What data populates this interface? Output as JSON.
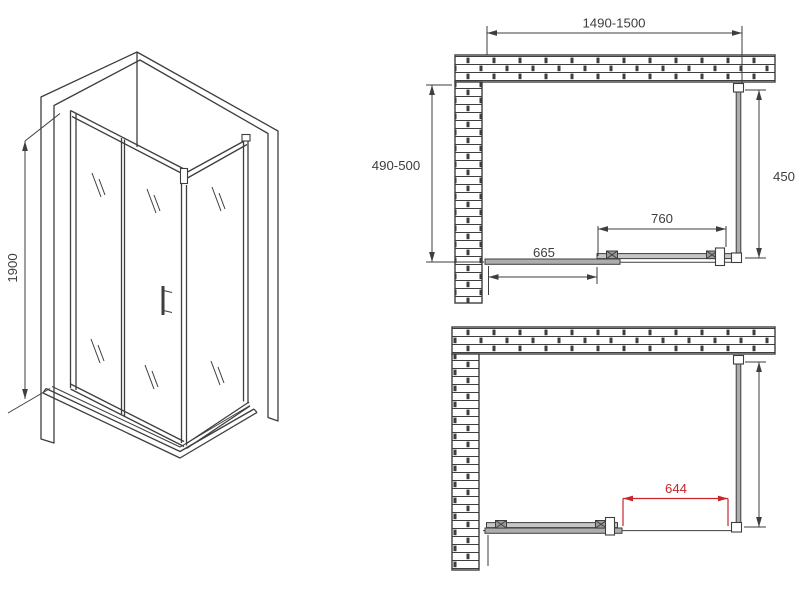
{
  "title": "Shower enclosure dimension drawing",
  "colors": {
    "line": "#3e3e3e",
    "dimension_red": "#c9252b",
    "panel_gray": "#adadad",
    "background": "#ffffff"
  },
  "isometric_view": {
    "height_label": "1900"
  },
  "top_plan_view": {
    "total_width_label": "1490-1500",
    "side_depth_label": "490-500",
    "side_panel_label": "450",
    "door_width_label": "760",
    "fixed_panel_label": "665"
  },
  "open_plan_view": {
    "opening_width_label": "644"
  }
}
